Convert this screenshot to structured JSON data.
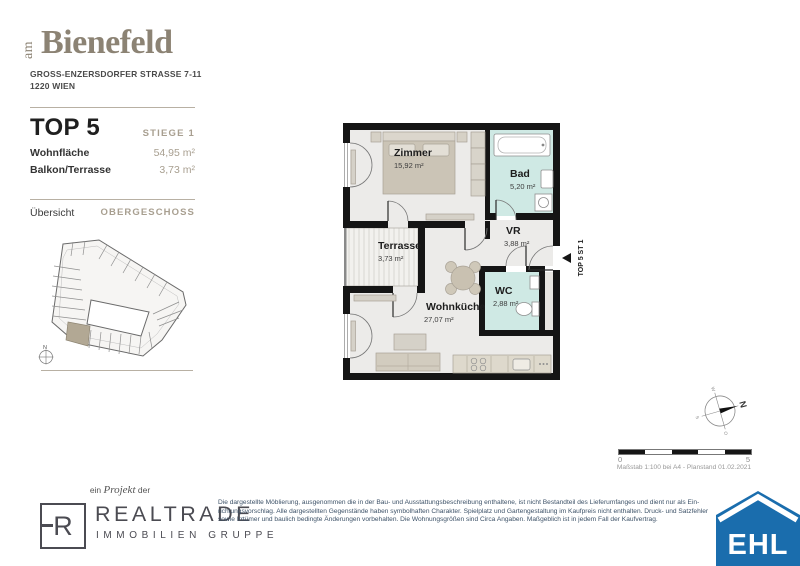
{
  "header": {
    "logo_prefix": "am",
    "logo_name": "Bienefeld",
    "address_line1": "GROSS-ENZERSDORFER STRASSE 7-11",
    "address_line2": "1220 WIEN",
    "unit_title": "TOP 5",
    "stiege": "STIEGE 1",
    "metrics": [
      {
        "label": "Wohnfläche",
        "value": "54,95 m²"
      },
      {
        "label": "Balkon/Terrasse",
        "value": "3,73 m²"
      }
    ],
    "overview_label": "Übersicht",
    "level_label": "OBERGESCHOSS",
    "mini_compass_n": "N"
  },
  "plan": {
    "rooms": [
      {
        "name": "Zimmer",
        "area": "15,92 m²"
      },
      {
        "name": "Bad",
        "area": "5,20 m²"
      },
      {
        "name": "VR",
        "area": "3,88 m²"
      },
      {
        "name": "WC",
        "area": "2,88 m²"
      },
      {
        "name": "Wohnküche",
        "area": "27,07 m²"
      },
      {
        "name": "Terrasse",
        "area": "3,73 m²"
      }
    ],
    "entrance_label": "TOP 5 ST 1",
    "compass": {
      "n": "N",
      "e": "O",
      "s": "S",
      "w": "W"
    },
    "scalebar": {
      "start": "0",
      "end": "5",
      "caption": "Maßstab 1:100 bei A4 - Planstand 01.02.2021"
    }
  },
  "footer": {
    "project_pre": "ein",
    "project_word": "Projekt",
    "project_post": "der",
    "realtrade_letter": "R",
    "realtrade_name": "REALTRADE",
    "realtrade_sub": "IMMOBILIEN GRUPPE",
    "disclaimer_lines": [
      "Die dargestellte Möblierung, ausgenommen die in der Bau- und Ausstattungsbeschreibung enthaltene, ist nicht Bestandteil des Lieferumfanges und dient nur als Ein-",
      "richtungsvorschlag. Alle dargestellten Gegenstände haben symbolhaften Charakter. Spielplatz und Gartengestaltung im Kaufpreis nicht enthalten. Druck- und Satzfehler",
      "sowie Irrtümer und baulich bedingte Änderungen vorbehalten. Die Wohnungsgrößen sind Circa Angaben. Maßgeblich ist in jedem Fall der Kaufvertrag."
    ],
    "ehl": "EHL"
  },
  "colors": {
    "accent_brown": "#8c8374",
    "muted_value": "#a89f90",
    "wall": "#151515",
    "wet_room_floor": "#cfe9e4",
    "room_floor": "#ecebe9",
    "furniture": "#cbc4b6",
    "highlight_unit": "#b2a894",
    "ehl_blue": "#1a6dad"
  }
}
